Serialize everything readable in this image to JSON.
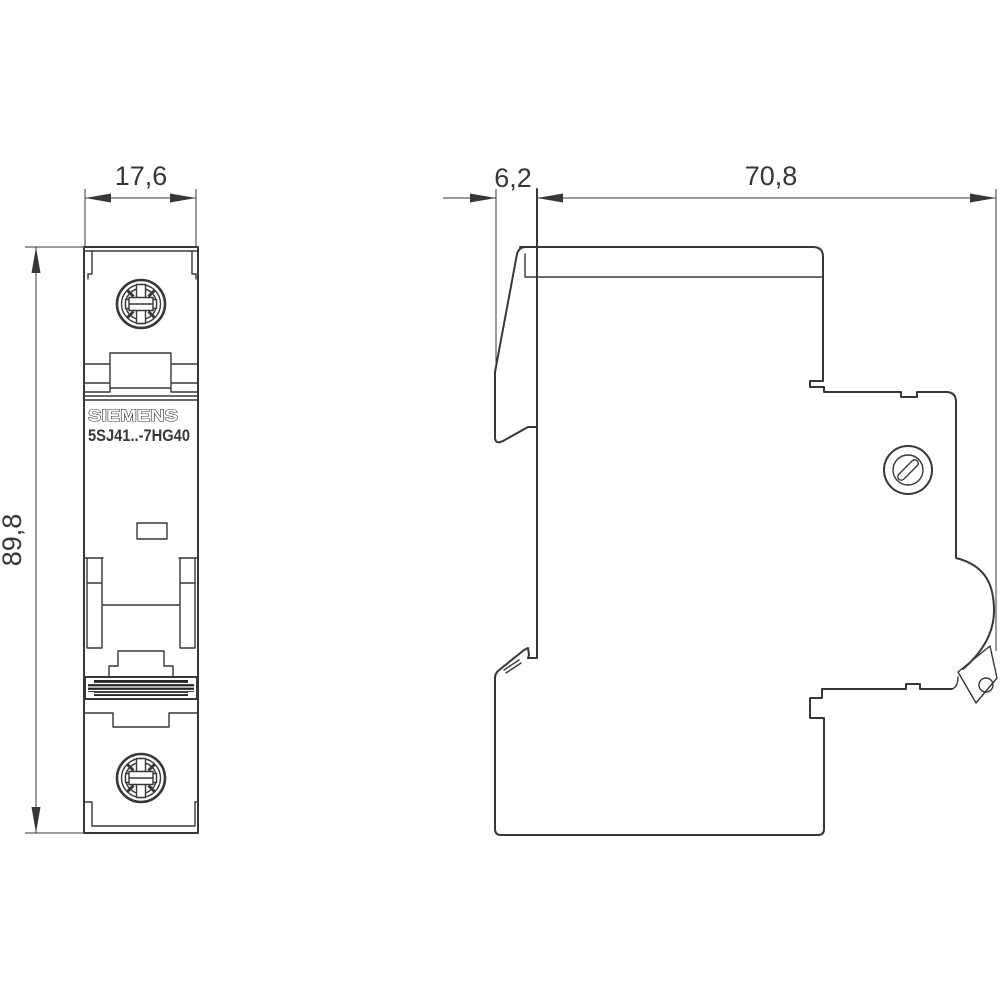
{
  "drawing": {
    "brand": "SIEMENS",
    "model": "5SJ41..-7HG40",
    "dimensions": {
      "front_width_mm": "17,6",
      "front_height_mm": "89,8",
      "lever_protrusion_mm": "6,2",
      "body_depth_mm": "70,8"
    },
    "colors": {
      "line": "#373737",
      "background": "#ffffff",
      "grip_fill": "#262626"
    }
  }
}
